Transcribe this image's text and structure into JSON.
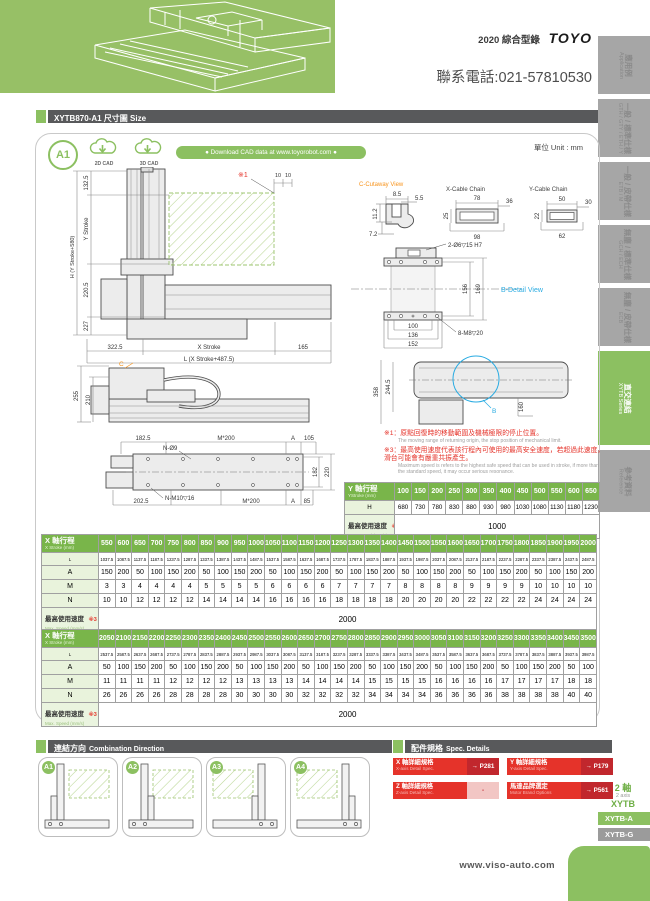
{
  "page": {
    "catalog": "2020 綜合型錄",
    "brand": "TOYO",
    "phone": "聯系電話:021-57810530",
    "footer_url": "www.viso-auto.com"
  },
  "sidebar": {
    "tabs": [
      {
        "zh": "應用例",
        "en": "Application"
      },
      {
        "zh": "一般 / 標準仕樣",
        "en": "GTH / GTY / ETH / Y"
      },
      {
        "zh": "一般 / 皮帶仕樣",
        "en": "ETB / M"
      },
      {
        "zh": "無塵 / 標準仕樣",
        "en": "GCH / ECH"
      },
      {
        "zh": "無塵 / 皮帶仕樣",
        "en": "ECB"
      },
      {
        "zh": "直交連結",
        "en": "XYTB Series"
      },
      {
        "zh": "參考資料",
        "en": "Reference"
      }
    ],
    "series": {
      "axis_zh": "2 軸",
      "axis_en": "2 axis",
      "name": "XYTB",
      "item_a": "XYTB-A",
      "item_g": "XYTB-G"
    }
  },
  "header": {
    "title": "XYTB870-A1 尺寸圖 Size"
  },
  "panel": {
    "badge": "A1",
    "cad2d": "2D CAD",
    "cad3d": "3D CAD",
    "download": "● Download CAD data at www.toyorobot.com ●",
    "unit": "單位 Unit : mm"
  },
  "drawings": {
    "front": {
      "note_mark": "※1",
      "d10a": "10",
      "d10b": "10",
      "h_label": "H (Y Stroke+580)",
      "d1325": "132.5",
      "y_stroke": "Y Stroke",
      "d2205": "220.5",
      "d227": "227",
      "d3225": "322.5",
      "x_stroke": "X Stroke",
      "d165": "165",
      "l_label": "L (X Stroke+487.5)"
    },
    "cutaway": {
      "title": "C-Cutaway View",
      "d85": "8.5",
      "d55": "5.5",
      "d112": "11.2",
      "d72": "7.2"
    },
    "xchain": {
      "title": "X-Cable Chain",
      "top": "78",
      "right": "36",
      "left": "25",
      "bottom": "98"
    },
    "ychain": {
      "title": "Y-Cable Chain",
      "top": "50",
      "right": "30",
      "left": "22",
      "bottom": "62"
    },
    "bdetail": {
      "title": "B-Detail View",
      "hole_top": "2-Ø6▽15 H7",
      "d156": "156",
      "d169": "169",
      "d100": "100",
      "d136": "136",
      "d152": "152",
      "hole_bottom": "8-M8▽20"
    },
    "side": {
      "c_label": "C",
      "d255": "255",
      "d210": "210"
    },
    "plan": {
      "d1825": "182.5",
      "m200_top": "M*200",
      "a_top": "A",
      "d105": "105",
      "n_o9": "N-Ø9",
      "d182": "182",
      "d220": "220",
      "d2025": "202.5",
      "n_m10": "N-M10▽16",
      "m200_bot": "M*200",
      "a_bot": "A",
      "d85": "85"
    },
    "ytop": {
      "d358": "358",
      "d2445": "244.5",
      "d160": "160",
      "b_label": "B"
    }
  },
  "notes": [
    {
      "mark": "※1：",
      "zh": "原點回復時的移動範圍及機械極限的停止位置。",
      "en": "The moving range of returning origin, the stop position of mechanical limit."
    },
    {
      "mark": "※3：",
      "zh": "最高使用速度代表該行程內可使用的最高安全速度，若超過此速度，滑台可能會有嚴重共振產生。",
      "en": "Maximum speed is refers to the highest safe speed that can be used in stroke, if more than the standard speed, it may occur serious resonance."
    }
  ],
  "y_table": {
    "header_zh": "Y 軸行程",
    "header_en": "YStroke (mm)",
    "strokes": [
      "100",
      "150",
      "200",
      "250",
      "300",
      "350",
      "400",
      "450",
      "500",
      "550",
      "600",
      "650"
    ],
    "h_label": "H",
    "h_values": [
      "680",
      "730",
      "780",
      "830",
      "880",
      "930",
      "980",
      "1030",
      "1080",
      "1130",
      "1180",
      "1230"
    ],
    "speed_zh": "最高使用速度",
    "speed_mk": "※3",
    "speed_en": "Max. Speed (mm/s)",
    "speed_value": "1000"
  },
  "x_table1": {
    "header_zh": "X 軸行程",
    "header_en": "X Stroke (mm)",
    "strokes": [
      "550",
      "600",
      "650",
      "700",
      "750",
      "800",
      "850",
      "900",
      "950",
      "1000",
      "1050",
      "1100",
      "1150",
      "1200",
      "1250",
      "1300",
      "1350",
      "1400",
      "1450",
      "1500",
      "1550",
      "1600",
      "1650",
      "1700",
      "1750",
      "1800",
      "1850",
      "1900",
      "1950",
      "2000"
    ],
    "row_labels": {
      "L": "L",
      "A": "A",
      "M": "M",
      "N": "N"
    },
    "L": [
      "1037.5",
      "1087.5",
      "1137.5",
      "1187.5",
      "1237.5",
      "1287.5",
      "1337.5",
      "1387.5",
      "1437.5",
      "1487.5",
      "1537.5",
      "1587.5",
      "1637.5",
      "1687.5",
      "1737.5",
      "1787.5",
      "1837.5",
      "1887.5",
      "1937.5",
      "1987.5",
      "2037.5",
      "2087.5",
      "2137.5",
      "2187.5",
      "2237.5",
      "2287.5",
      "2337.5",
      "2387.5",
      "2437.5",
      "2487.5"
    ],
    "A": [
      "150",
      "200",
      "50",
      "100",
      "150",
      "200",
      "50",
      "100",
      "150",
      "200",
      "50",
      "100",
      "150",
      "200",
      "50",
      "100",
      "150",
      "200",
      "50",
      "100",
      "150",
      "200",
      "50",
      "100",
      "150",
      "200",
      "50",
      "100",
      "150",
      "200"
    ],
    "M": [
      "3",
      "3",
      "4",
      "4",
      "4",
      "4",
      "5",
      "5",
      "5",
      "5",
      "6",
      "6",
      "6",
      "6",
      "7",
      "7",
      "7",
      "7",
      "8",
      "8",
      "8",
      "8",
      "9",
      "9",
      "9",
      "9",
      "10",
      "10",
      "10",
      "10"
    ],
    "N": [
      "10",
      "10",
      "12",
      "12",
      "12",
      "12",
      "14",
      "14",
      "14",
      "14",
      "16",
      "16",
      "16",
      "16",
      "18",
      "18",
      "18",
      "18",
      "20",
      "20",
      "20",
      "20",
      "22",
      "22",
      "22",
      "22",
      "24",
      "24",
      "24",
      "24"
    ],
    "speed_zh": "最高使用速度",
    "speed_mk": "※3",
    "speed_en": "Max. Speed (mm/s)",
    "speed_value": "2000"
  },
  "x_table2": {
    "header_zh": "X 軸行程",
    "header_en": "X Stroke (mm)",
    "strokes": [
      "2050",
      "2100",
      "2150",
      "2200",
      "2250",
      "2300",
      "2350",
      "2400",
      "2450",
      "2500",
      "2550",
      "2600",
      "2650",
      "2700",
      "2750",
      "2800",
      "2850",
      "2900",
      "2950",
      "3000",
      "3050",
      "3100",
      "3150",
      "3200",
      "3250",
      "3300",
      "3350",
      "3400",
      "3450",
      "3500"
    ],
    "row_labels": {
      "L": "L",
      "A": "A",
      "M": "M",
      "N": "N"
    },
    "L": [
      "2537.5",
      "2587.5",
      "2637.5",
      "2687.5",
      "2737.5",
      "2787.5",
      "2837.5",
      "2887.5",
      "2937.5",
      "2987.5",
      "3037.5",
      "3087.5",
      "3137.5",
      "3187.5",
      "3237.5",
      "3287.5",
      "3337.5",
      "3387.5",
      "3437.5",
      "3487.5",
      "3537.5",
      "3587.5",
      "3637.5",
      "3687.5",
      "3737.5",
      "3787.5",
      "3837.5",
      "3887.5",
      "3937.5",
      "3987.5"
    ],
    "A": [
      "50",
      "100",
      "150",
      "200",
      "50",
      "100",
      "150",
      "200",
      "50",
      "100",
      "150",
      "200",
      "50",
      "100",
      "150",
      "200",
      "50",
      "100",
      "150",
      "200",
      "50",
      "100",
      "150",
      "200",
      "50",
      "100",
      "150",
      "200",
      "50",
      "100"
    ],
    "M": [
      "11",
      "11",
      "11",
      "11",
      "12",
      "12",
      "12",
      "12",
      "13",
      "13",
      "13",
      "13",
      "14",
      "14",
      "14",
      "14",
      "15",
      "15",
      "15",
      "15",
      "16",
      "16",
      "16",
      "16",
      "17",
      "17",
      "17",
      "17",
      "18",
      "18"
    ],
    "N": [
      "26",
      "26",
      "26",
      "26",
      "28",
      "28",
      "28",
      "28",
      "30",
      "30",
      "30",
      "30",
      "32",
      "32",
      "32",
      "32",
      "34",
      "34",
      "34",
      "34",
      "36",
      "36",
      "36",
      "36",
      "38",
      "38",
      "38",
      "38",
      "40",
      "40"
    ],
    "speed_zh": "最高使用速度",
    "speed_mk": "※3",
    "speed_en": "Max. Speed (mm/s)",
    "speed_value": "2000"
  },
  "combination": {
    "title_zh": "連結方向",
    "title_en": "Combination Direction",
    "cards": [
      "A1",
      "A2",
      "A3",
      "A4"
    ]
  },
  "spec": {
    "title_zh": "配件規格",
    "title_en": "Spec. Details",
    "items": [
      {
        "zh": "X 軸詳細規格",
        "en": "X-axis Detail Spec.",
        "page": "→ P281"
      },
      {
        "zh": "Y 軸詳細規格",
        "en": "Y-axis Detail Spec.",
        "page": "→ P179"
      },
      {
        "zh": "Z 軸詳細規格",
        "en": "Z-axis Detail Spec.",
        "page": "-"
      },
      {
        "zh": "馬達品牌選定",
        "en": "Motor Brand Options",
        "page": "→ P561"
      }
    ]
  },
  "colors": {
    "brand_green": "#8cc061",
    "table_green": "#79b54a",
    "dark_bar": "#58595b",
    "red": "#e5332a",
    "blue": "#29abe2",
    "orange": "#f7941d"
  }
}
